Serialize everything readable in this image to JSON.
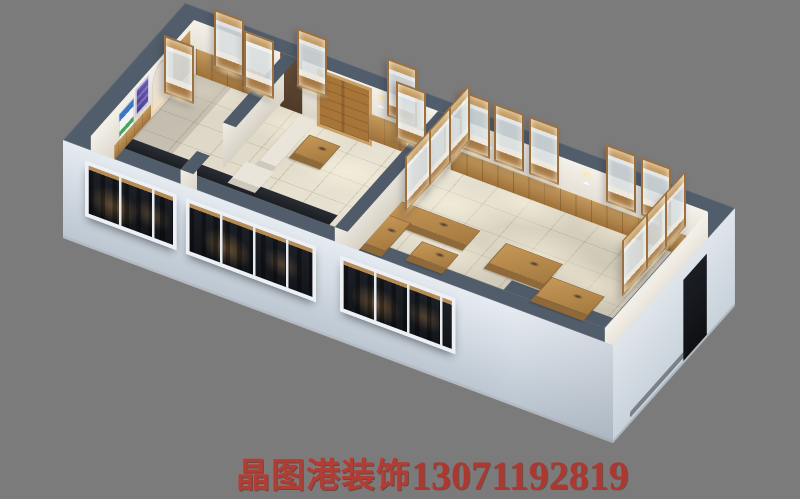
{
  "meta": {
    "type": "3d-interior-render",
    "description": "Isometric cutaway 3D rendering of a jewelry / exhibition shop interior with three rooms, glass display showcases, wooden counters, double doors and front window walls, on a plain gray background",
    "background": "#7b7b7b"
  },
  "watermark": {
    "brand": "晶图港装饰",
    "phone": "13071192819",
    "brand_color": "#b5392e",
    "phone_color": "#b2332a"
  },
  "colors": {
    "background": "#7b7b7b",
    "wall_top": "#515d6a",
    "exterior_wall": "#d6dee6",
    "interior_wall": "#ece8df",
    "floor": "#d9d2c1",
    "wood": "#ad8048",
    "window_glass": "#171b21",
    "poster_purple": "#5b4aa4",
    "poster_blue": "#3a76c2",
    "sconce_glow": "#ffe9a2"
  }
}
